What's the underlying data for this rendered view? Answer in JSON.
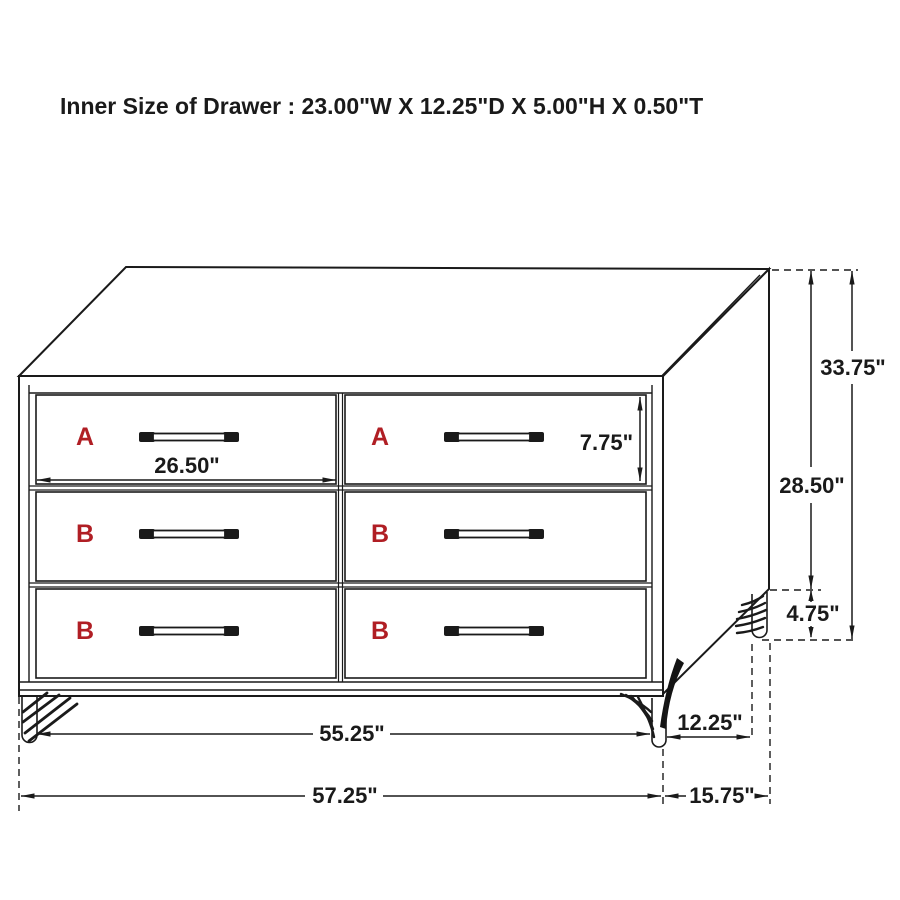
{
  "title": "Inner Size of Drawer : 23.00\"W X 12.25\"D X 5.00\"H X 0.50\"T",
  "colors": {
    "line": "#1a1a1a",
    "drawer_label_red": "#b01e24",
    "background": "#ffffff"
  },
  "drawers": [
    {
      "position": "top-left",
      "label": "A"
    },
    {
      "position": "top-right",
      "label": "A"
    },
    {
      "position": "middle-left",
      "label": "B"
    },
    {
      "position": "middle-right",
      "label": "B"
    },
    {
      "position": "bottom-left",
      "label": "B"
    },
    {
      "position": "bottom-right",
      "label": "B"
    }
  ],
  "dimensions": {
    "drawer_front_width": "26.50\"",
    "drawer_front_height": "7.75\"",
    "overall_height": "33.75\"",
    "body_height": "28.50\"",
    "leg_height": "4.75\"",
    "body_width": "55.25\"",
    "overall_width": "57.25\"",
    "side_depth": "12.25\"",
    "overall_depth": "15.75\""
  }
}
